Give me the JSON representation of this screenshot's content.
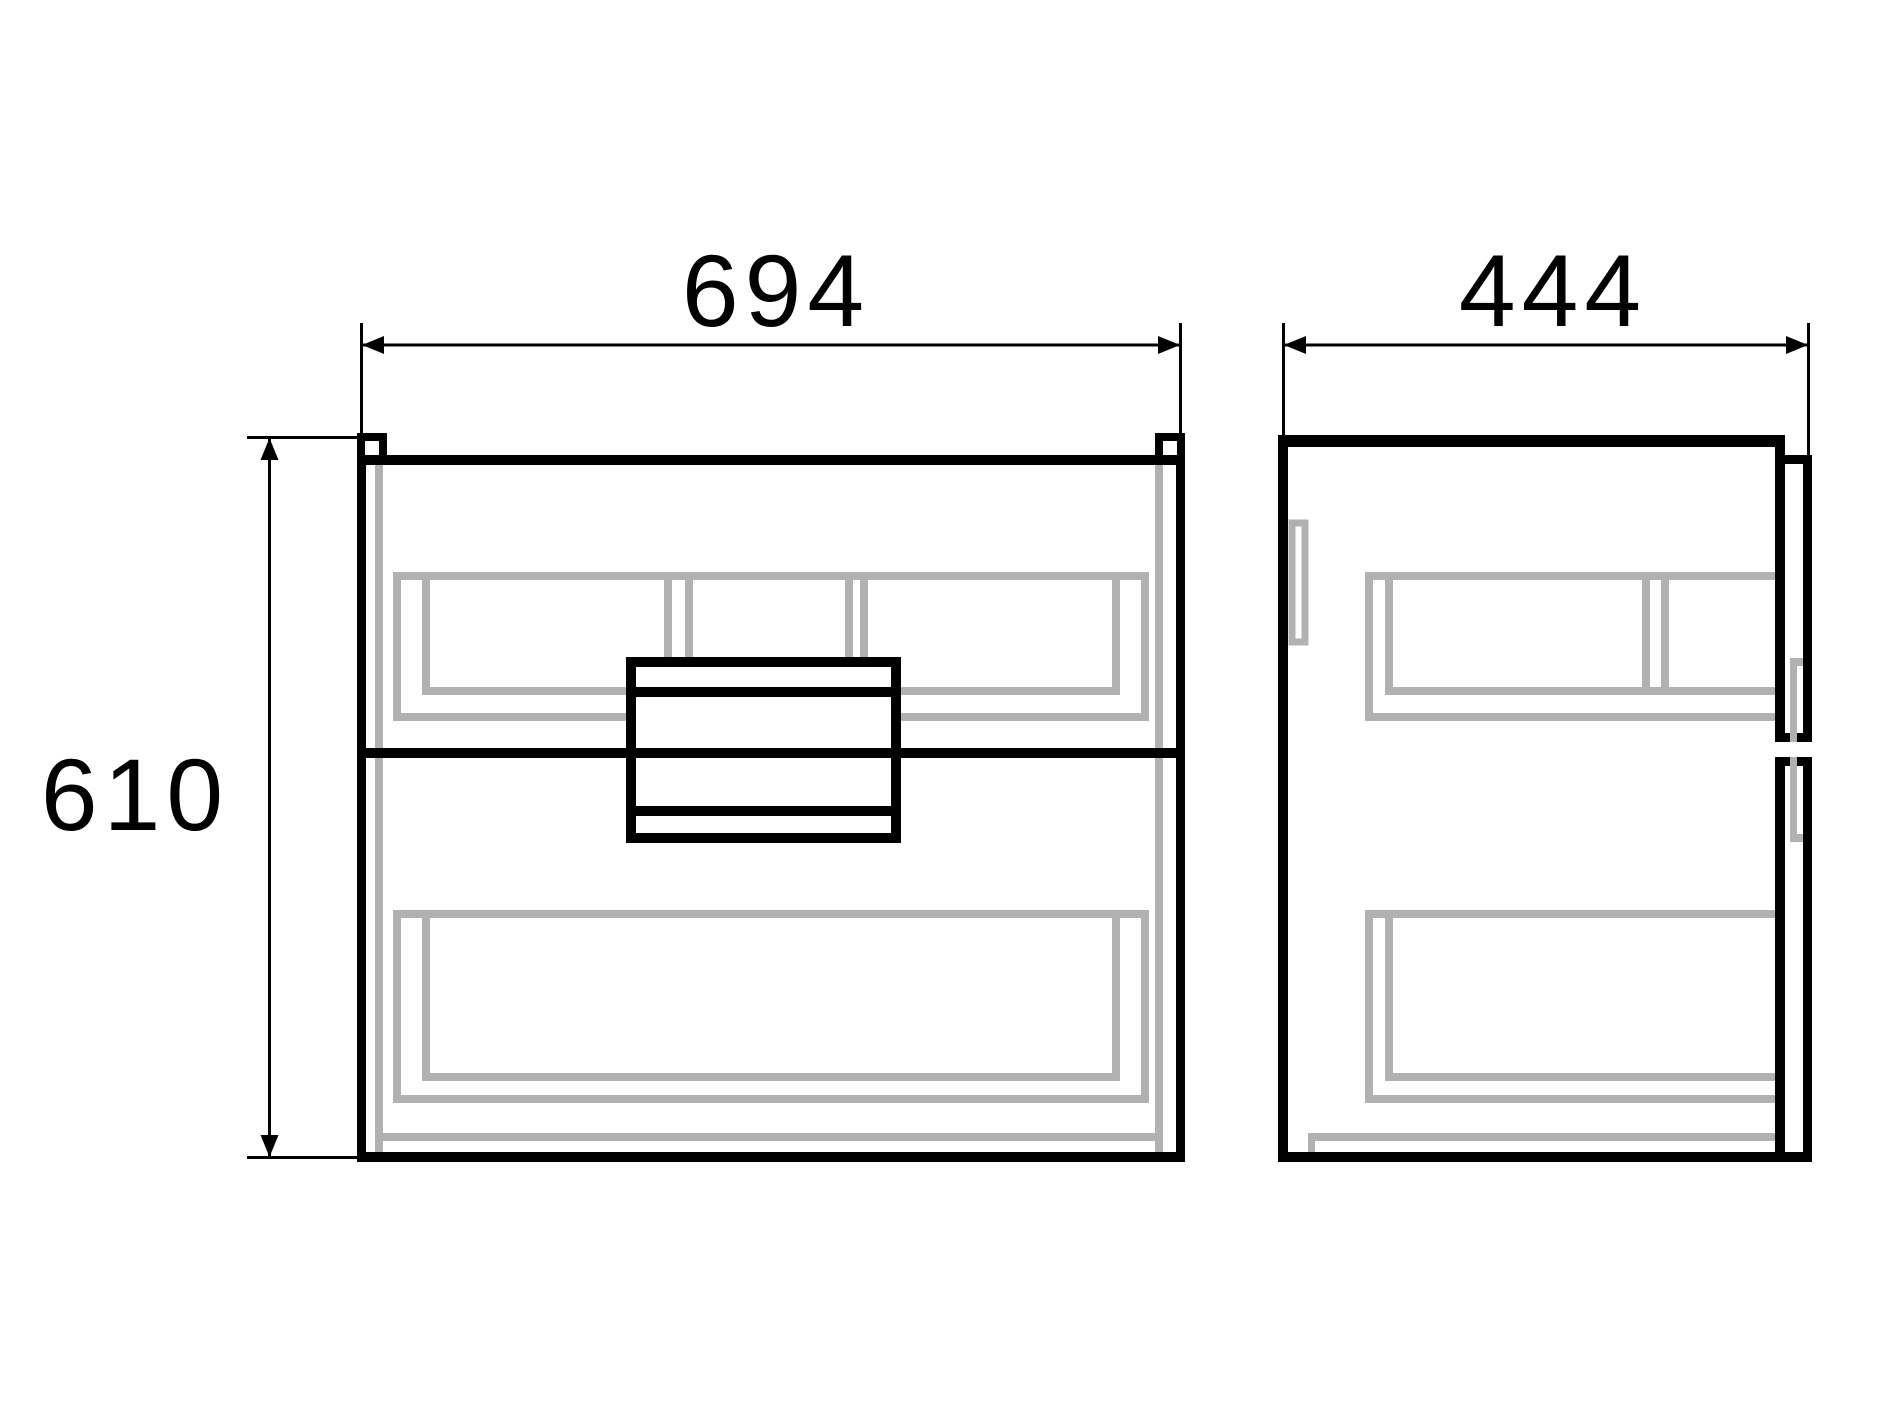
{
  "drawing": {
    "labels": {
      "front_width": "694",
      "side_depth": "444",
      "height": "610"
    },
    "colors": {
      "outline": "#000000",
      "hidden_lines": "#b1b1b1",
      "background": "#ffffff"
    }
  }
}
